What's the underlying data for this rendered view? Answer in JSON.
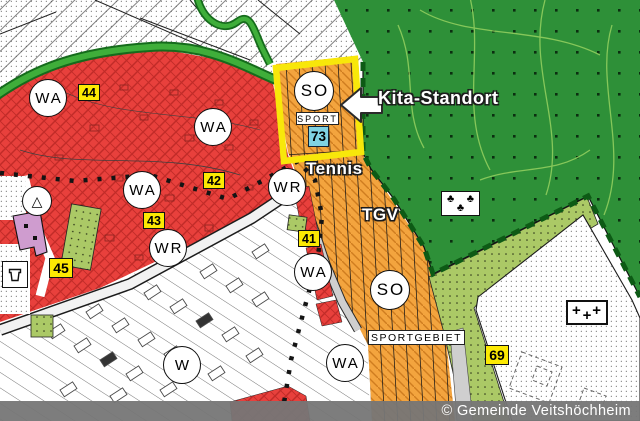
{
  "credit": "© Gemeinde Veitshöchheim",
  "callout": {
    "label": "Kita-Standort"
  },
  "site": {
    "zone": "SO",
    "use_label": "SPORT",
    "number": "73"
  },
  "area_labels": {
    "tennis": "Tennis",
    "club": "TGV",
    "sport_area": "SPORTGEBIET"
  },
  "zones": [
    "WA",
    "WA",
    "WA",
    "WR",
    "WR",
    "WA",
    "WA",
    "W",
    "SO"
  ],
  "badges": [
    "44",
    "42",
    "43",
    "45",
    "41",
    "69"
  ],
  "symbols": {
    "triangle": "△",
    "clover": "♣",
    "plus": "+"
  },
  "colors": {
    "residential": "#e8403c",
    "sport": "#f3a43e",
    "forest": "#2e9038",
    "meadow": "#abc966",
    "highlight": "#f8e70a",
    "site_number_bg": "#7fd2e2",
    "badge": "#fce903"
  }
}
